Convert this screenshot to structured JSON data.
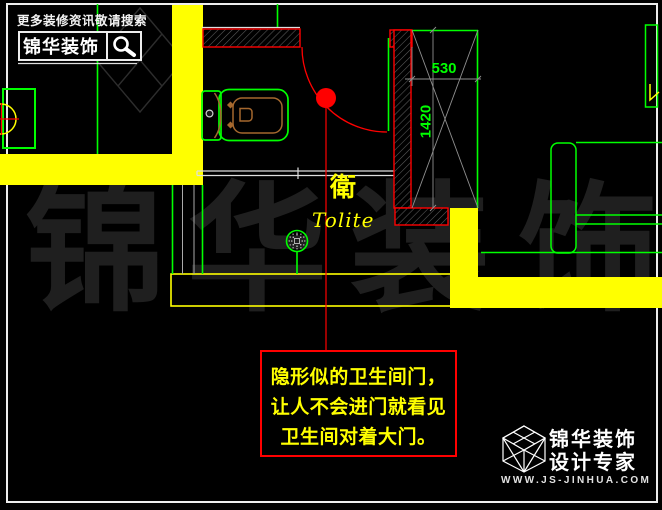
{
  "header_promo": {
    "tagline": "更多装修资讯敬请搜索",
    "brand": "锦华装饰",
    "search_icon": "magnifier"
  },
  "floorplan": {
    "room_label_cn": "衛",
    "room_label_en": "Tolite",
    "dimensions": {
      "niche_width_mm": "530",
      "niche_height_mm": "1420"
    },
    "annotation_lines": [
      "隐形似的卫生间门，",
      "让人不会进门就看见",
      "卫生间对着大门。"
    ]
  },
  "watermark_chars": [
    "锦",
    "华",
    "装",
    "饰"
  ],
  "footer_logo": {
    "brand": "锦华装饰",
    "tagline": "设计专家",
    "website": "WWW.JS-JINHUA.COM",
    "cube_icon": "isometric-cube"
  },
  "palette": {
    "highlight_yellow": "#ffff00",
    "cad_green": "#00ff00",
    "cad_red": "#ff0000",
    "sheet_white": "#ededed",
    "fixture_orange": "#a5682e",
    "watermark_gray": "#1f1f1f"
  }
}
